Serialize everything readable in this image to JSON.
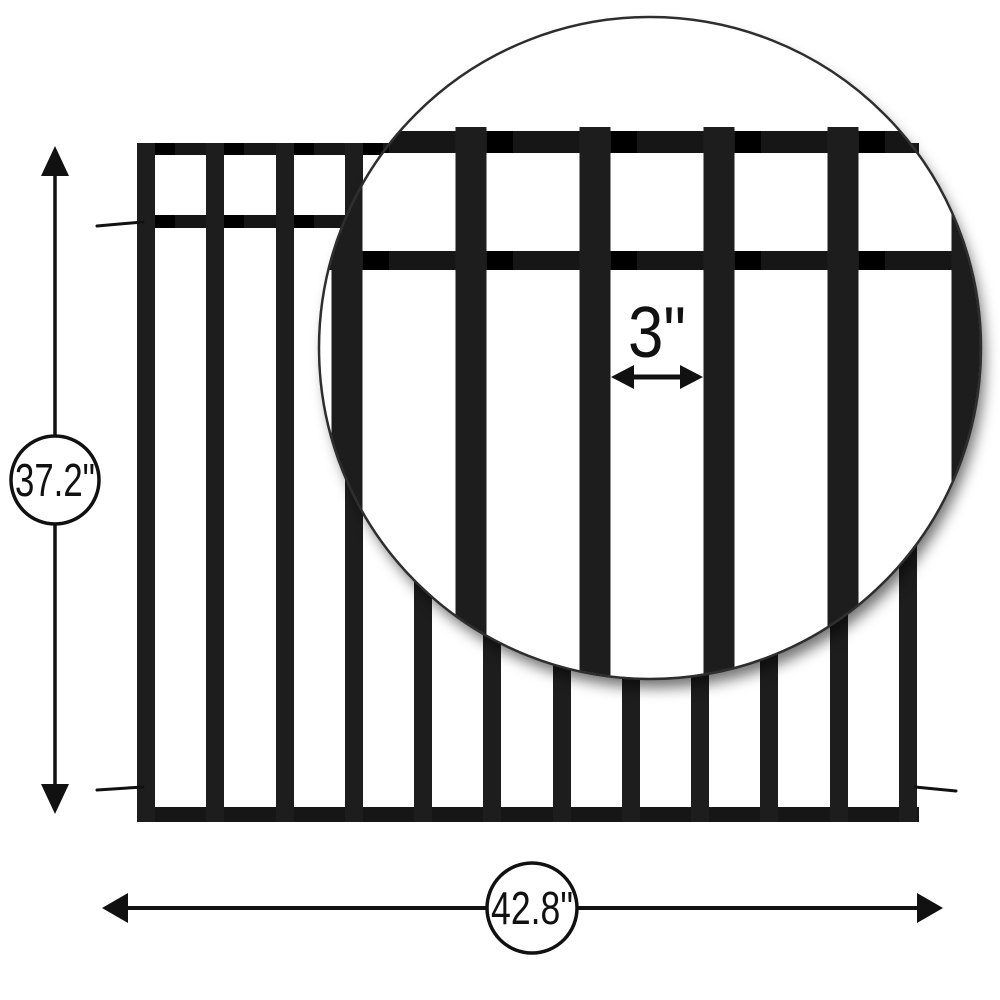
{
  "diagram": {
    "title": "Fence panel dimension diagram",
    "type": "product-dimensions",
    "subject": "flat-top metal fence panel with vertical pickets"
  },
  "dimensions": {
    "height": {
      "value": "37.2\""
    },
    "width": {
      "value": "42.8\""
    },
    "picket_spacing": {
      "value": "3\""
    }
  },
  "fence": {
    "picket_count": 12,
    "rail_count": 3,
    "magnifier_picket_count": 6
  },
  "colors": {
    "ink": "#111111",
    "picket": "#1d1d1d",
    "rail": "#161616",
    "connector": "#000000",
    "bg": "#ffffff"
  }
}
